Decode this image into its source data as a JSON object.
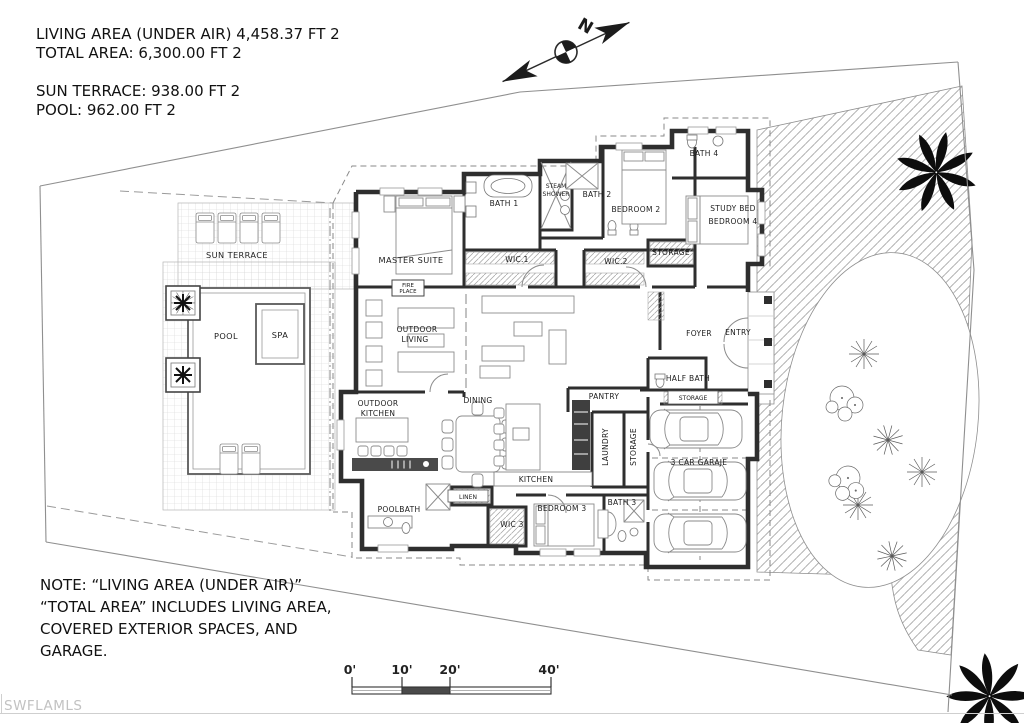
{
  "title_block": {
    "line1": "LIVING AREA (UNDER AIR) 4,458.37 FT 2",
    "line2": "TOTAL AREA: 6,300.00 FT 2",
    "line3": "SUN TERRACE: 938.00 FT 2",
    "line4": "POOL: 962.00 FT 2"
  },
  "compass": {
    "north": "N"
  },
  "rooms": {
    "master_suite": "MASTER SUITE",
    "bath_1": "BATH 1",
    "steam_1": "STEAM",
    "steam_2": "SHOWER",
    "bath_2": "BATH 2",
    "bedroom_2": "BEDROOM 2",
    "bath_4": "BATH 4",
    "study_1": "STUDY BED",
    "study_2": "BEDROOM 4",
    "storage_upper": "STORAGE",
    "wic_1": "WIC.1",
    "wic_2": "WIC.2",
    "foyer": "FOYER",
    "entry": "ENTRY",
    "outdoor_living_1": "OUTDOOR",
    "outdoor_living_2": "LIVING",
    "fire_1": "FIRE",
    "fire_2": "PLACE",
    "half_bath": "HALF BATH",
    "storage_entry": "STORAGE",
    "outdoor_kitchen_1": "OUTDOOR",
    "outdoor_kitchen_2": "KITCHEN",
    "dining": "DINING",
    "pantry": "PANTRY",
    "laundry": "LAUNDRY",
    "storage_garage": "STORAGE",
    "garage": "3 CAR GARAJE",
    "kitchen": "KITCHEN",
    "poolbath": "POOLBATH",
    "linen": "LINEN",
    "wic_3": "WIC 3",
    "bedroom_3": "BEDROOM 3",
    "bath_3": "BATH 3",
    "sun_terrace": "SUN TERRACE",
    "pool": "POOL",
    "spa": "SPA"
  },
  "note": {
    "line1": "NOTE: “LIVING AREA (UNDER AIR)”",
    "line2": "“TOTAL AREA” INCLUDES LIVING AREA,",
    "line3": "COVERED EXTERIOR SPACES, AND",
    "line4": "GARAGE."
  },
  "scale_bar": {
    "t0": "0'",
    "t1": "10'",
    "t2": "20'",
    "t3": "40'"
  },
  "watermark": "SWFLAMLS",
  "colors": {
    "wall": "#2e2e2e",
    "line": "#8c8c8c",
    "watermark": "#c2c2c2",
    "background": "#ffffff"
  }
}
